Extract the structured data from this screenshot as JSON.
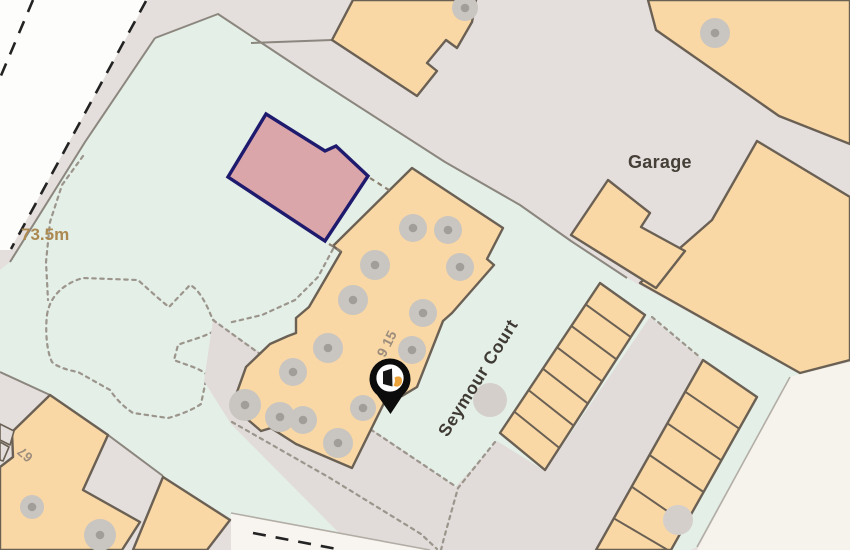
{
  "map": {
    "type": "property-location-map",
    "labels": {
      "garage": "Garage",
      "street_name": "Seymour Court",
      "spot_height": "73.5m",
      "house_number": "67",
      "building_numbers": "9 15"
    },
    "marker": {
      "name": "property-location-pin",
      "pin_color": "#0c0c0c",
      "accent_color": "#eda33b"
    },
    "colors": {
      "open_area_green": "#e4efe7",
      "urban_grey": "#e4dfdc",
      "building_fill": "#f9d8a5",
      "building_outline": "#6b6054",
      "plot_fill": "#dba6aa",
      "plot_outline": "#1e1a6d",
      "road_white": "#fdfdfb"
    }
  }
}
